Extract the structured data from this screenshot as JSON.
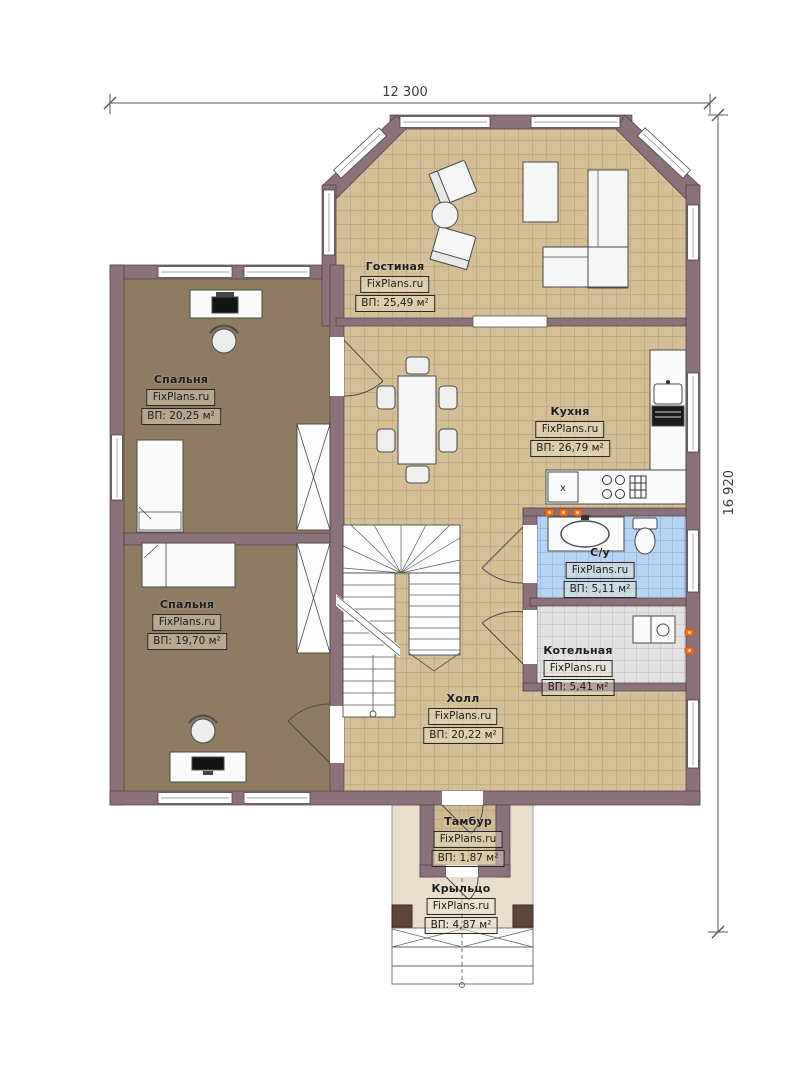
{
  "plan": {
    "watermark": "FixPlans.ru",
    "dimensions": {
      "width_label": "12 300",
      "height_label": "16 920"
    },
    "kitchen_mark": "x",
    "rooms": [
      {
        "id": "living",
        "name": "Гостиная",
        "site": "FixPlans.ru",
        "area": "ВП: 25,49 м²"
      },
      {
        "id": "bedroom-top",
        "name": "Спальня",
        "site": "FixPlans.ru",
        "area": "ВП: 20,25 м²"
      },
      {
        "id": "bedroom-bottom",
        "name": "Спальня",
        "site": "FixPlans.ru",
        "area": "ВП: 19,70 м²"
      },
      {
        "id": "kitchen",
        "name": "Кухня",
        "site": "FixPlans.ru",
        "area": "ВП: 26,79 м²"
      },
      {
        "id": "bathroom",
        "name": "С/у",
        "site": "FixPlans.ru",
        "area": "ВП: 5,11 м²"
      },
      {
        "id": "boiler",
        "name": "Котельная",
        "site": "FixPlans.ru",
        "area": "ВП: 5,41 м²"
      },
      {
        "id": "hall",
        "name": "Холл",
        "site": "FixPlans.ru",
        "area": "ВП: 20,22 м²"
      },
      {
        "id": "vestibule",
        "name": "Тамбур",
        "site": "FixPlans.ru",
        "area": "ВП: 1,87 м²"
      },
      {
        "id": "porch",
        "name": "Крыльцо",
        "site": "FixPlans.ru",
        "area": "ВП: 4,87 м²"
      }
    ],
    "colors": {
      "wall": "#8a717a",
      "floor_tan": "#d5bf97",
      "floor_brown": "#8f7b62",
      "floor_blue": "#b7d3f2",
      "floor_gray": "#e2e2e2",
      "porch": "#e9decb",
      "radiator_orange": "#f07020"
    }
  }
}
